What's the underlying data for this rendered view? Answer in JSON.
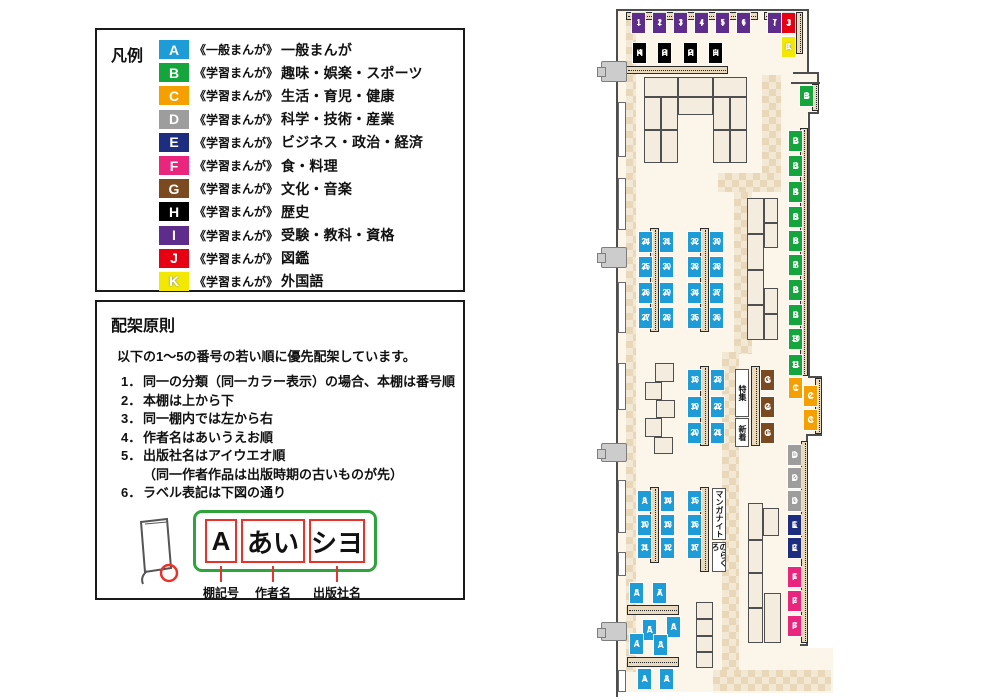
{
  "colors": {
    "A": "#1e9cd8",
    "B": "#14a53c",
    "C": "#f6a000",
    "D": "#9d9d9e",
    "E": "#1d2e80",
    "F": "#e9257e",
    "G": "#7c4a21",
    "H": "#000000",
    "I": "#5e2d8c",
    "J": "#e60012",
    "K": "#f3e900"
  },
  "legend": {
    "title": "凡例",
    "items": [
      {
        "code": "A",
        "series": "《一般まんが》",
        "category": "一般まんが"
      },
      {
        "code": "B",
        "series": "《学習まんが》",
        "category": "趣味・娯楽・スポーツ"
      },
      {
        "code": "C",
        "series": "《学習まんが》",
        "category": "生活・育児・健康"
      },
      {
        "code": "D",
        "series": "《学習まんが》",
        "category": "科学・技術・産業"
      },
      {
        "code": "E",
        "series": "《学習まんが》",
        "category": "ビジネス・政治・経済"
      },
      {
        "code": "F",
        "series": "《学習まんが》",
        "category": "食・料理"
      },
      {
        "code": "G",
        "series": "《学習まんが》",
        "category": "文化・音楽"
      },
      {
        "code": "H",
        "series": "《学習まんが》",
        "category": "歴史"
      },
      {
        "code": "I",
        "series": "《学習まんが》",
        "category": "受験・教科・資格"
      },
      {
        "code": "J",
        "series": "《学習まんが》",
        "category": "図鑑"
      },
      {
        "code": "K",
        "series": "《学習まんが》",
        "category": "外国語"
      }
    ]
  },
  "principles": {
    "title": "配架原則",
    "intro": "以下の1～5の番号の若い順に優先配架しています。",
    "rules": [
      {
        "n": "1．",
        "t": "同一の分類（同一カラー表示）の場合、本棚は番号順"
      },
      {
        "n": "2．",
        "t": "本棚は上から下"
      },
      {
        "n": "3．",
        "t": "同一棚内では左から右"
      },
      {
        "n": "4．",
        "t": "作者名はあいうえお順"
      },
      {
        "n": "5．",
        "t": "出版社名はアイウエオ順",
        "sub": "（同一作者作品は出版時期の古いものが先）"
      },
      {
        "n": "6．",
        "t": "ラベル表記は下図の通り"
      }
    ],
    "diagram": {
      "cells": [
        {
          "text": "A",
          "caption": "棚記号",
          "w": 32
        },
        {
          "text": "あい",
          "caption": "作者名",
          "w": 64
        },
        {
          "text": "シヨ",
          "caption": "出版社名",
          "w": 56
        }
      ]
    }
  },
  "map": {
    "shelves": [
      {
        "id": "I1",
        "x": 632,
        "y": 13
      },
      {
        "id": "I2",
        "x": 653,
        "y": 13
      },
      {
        "id": "I3",
        "x": 674,
        "y": 13
      },
      {
        "id": "I4",
        "x": 695,
        "y": 13
      },
      {
        "id": "I5",
        "x": 716,
        "y": 13
      },
      {
        "id": "I6",
        "x": 737,
        "y": 13
      },
      {
        "id": "I7",
        "x": 768,
        "y": 13
      },
      {
        "id": "J1",
        "x": 782,
        "y": 13
      },
      {
        "id": "K1",
        "x": 782,
        "y": 37
      },
      {
        "id": "H4",
        "x": 633,
        "y": 43
      },
      {
        "id": "H3",
        "x": 658,
        "y": 43
      },
      {
        "id": "H2",
        "x": 684,
        "y": 43
      },
      {
        "id": "H1",
        "x": 709,
        "y": 43
      },
      {
        "id": "B1",
        "x": 800,
        "y": 86
      },
      {
        "id": "B2",
        "x": 789,
        "y": 131
      },
      {
        "id": "B3",
        "x": 789,
        "y": 156
      },
      {
        "id": "B4",
        "x": 789,
        "y": 182
      },
      {
        "id": "B5",
        "x": 789,
        "y": 207
      },
      {
        "id": "B6",
        "x": 789,
        "y": 231
      },
      {
        "id": "B7",
        "x": 789,
        "y": 255
      },
      {
        "id": "B8",
        "x": 789,
        "y": 280
      },
      {
        "id": "B9",
        "x": 789,
        "y": 305
      },
      {
        "id": "B10",
        "x": 789,
        "y": 329
      },
      {
        "id": "B11",
        "x": 789,
        "y": 355
      },
      {
        "id": "C1",
        "x": 789,
        "y": 378
      },
      {
        "id": "C2",
        "x": 804,
        "y": 386
      },
      {
        "id": "C3",
        "x": 804,
        "y": 410
      },
      {
        "id": "D1",
        "x": 788,
        "y": 445
      },
      {
        "id": "D2",
        "x": 788,
        "y": 468
      },
      {
        "id": "D3",
        "x": 788,
        "y": 491
      },
      {
        "id": "E1",
        "x": 788,
        "y": 515
      },
      {
        "id": "E2",
        "x": 788,
        "y": 538
      },
      {
        "id": "F1",
        "x": 788,
        "y": 567
      },
      {
        "id": "F2",
        "x": 788,
        "y": 591
      },
      {
        "id": "F3",
        "x": 788,
        "y": 616
      },
      {
        "id": "A24",
        "x": 639,
        "y": 232
      },
      {
        "id": "A25",
        "x": 639,
        "y": 257
      },
      {
        "id": "A26",
        "x": 639,
        "y": 283
      },
      {
        "id": "A27",
        "x": 639,
        "y": 308
      },
      {
        "id": "A31",
        "x": 660,
        "y": 232
      },
      {
        "id": "A30",
        "x": 660,
        "y": 257
      },
      {
        "id": "A29",
        "x": 660,
        "y": 283
      },
      {
        "id": "A28",
        "x": 660,
        "y": 308
      },
      {
        "id": "A32",
        "x": 688,
        "y": 232
      },
      {
        "id": "A33",
        "x": 688,
        "y": 257
      },
      {
        "id": "A34",
        "x": 688,
        "y": 283
      },
      {
        "id": "A35",
        "x": 688,
        "y": 308
      },
      {
        "id": "A39",
        "x": 710,
        "y": 232
      },
      {
        "id": "A38",
        "x": 710,
        "y": 257
      },
      {
        "id": "A37",
        "x": 710,
        "y": 283
      },
      {
        "id": "A36",
        "x": 710,
        "y": 308
      },
      {
        "id": "A18",
        "x": 688,
        "y": 370
      },
      {
        "id": "A19",
        "x": 688,
        "y": 397
      },
      {
        "id": "A20",
        "x": 688,
        "y": 423
      },
      {
        "id": "A23",
        "x": 711,
        "y": 370
      },
      {
        "id": "A22",
        "x": 711,
        "y": 397
      },
      {
        "id": "A21",
        "x": 711,
        "y": 423
      },
      {
        "id": "G3",
        "x": 761,
        "y": 370
      },
      {
        "id": "G2",
        "x": 761,
        "y": 397
      },
      {
        "id": "G1",
        "x": 761,
        "y": 423
      },
      {
        "id": "A9",
        "x": 638,
        "y": 491
      },
      {
        "id": "A10",
        "x": 638,
        "y": 515
      },
      {
        "id": "A11",
        "x": 638,
        "y": 538
      },
      {
        "id": "A14",
        "x": 661,
        "y": 491
      },
      {
        "id": "A13",
        "x": 661,
        "y": 515
      },
      {
        "id": "A12",
        "x": 661,
        "y": 538
      },
      {
        "id": "A15",
        "x": 688,
        "y": 491
      },
      {
        "id": "A16",
        "x": 688,
        "y": 515
      },
      {
        "id": "A17",
        "x": 688,
        "y": 538
      },
      {
        "id": "A8",
        "x": 630,
        "y": 583
      },
      {
        "id": "A7",
        "x": 653,
        "y": 583
      },
      {
        "id": "A5",
        "x": 643,
        "y": 620
      },
      {
        "id": "A6",
        "x": 667,
        "y": 617
      },
      {
        "id": "A4",
        "x": 630,
        "y": 634
      },
      {
        "id": "A3",
        "x": 654,
        "y": 635
      },
      {
        "id": "A1",
        "x": 638,
        "y": 669
      },
      {
        "id": "A2",
        "x": 660,
        "y": 669
      }
    ],
    "info_boxes": [
      {
        "text": "特集",
        "x": 735,
        "y": 369,
        "w": 14,
        "h": 48
      },
      {
        "text": "新着",
        "x": 735,
        "y": 418,
        "w": 14,
        "h": 29
      },
      {
        "text": "マンガナイト",
        "x": 712,
        "y": 488,
        "w": 14,
        "h": 52
      },
      {
        "text": "のらくろ",
        "x": 712,
        "y": 542,
        "w": 14,
        "h": 30
      }
    ]
  }
}
